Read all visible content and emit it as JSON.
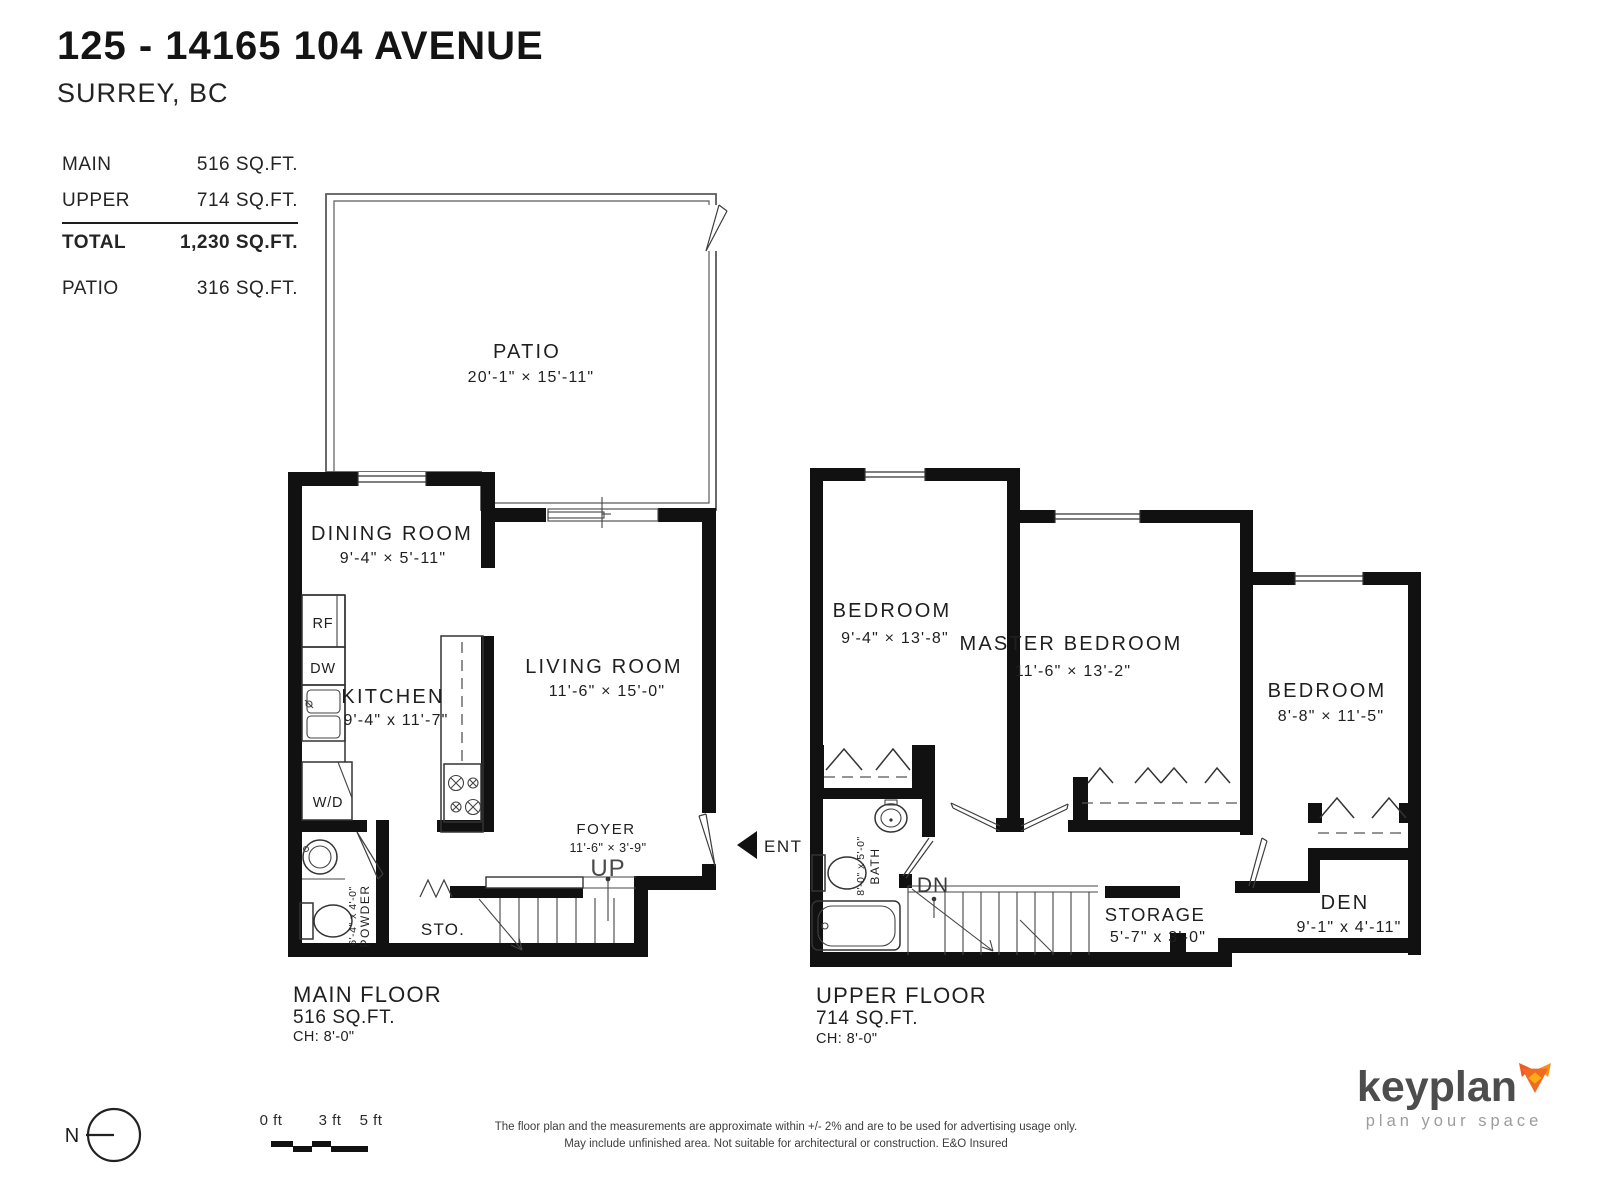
{
  "header": {
    "address": "125 - 14165 104 AVENUE",
    "city": "SURREY, BC"
  },
  "area_table": {
    "main": {
      "label": "MAIN",
      "value": "516 SQ.FT."
    },
    "upper": {
      "label": "UPPER",
      "value": "714 SQ.FT."
    },
    "total": {
      "label": "TOTAL",
      "value": "1,230 SQ.FT."
    },
    "patio": {
      "label": "PATIO",
      "value": "316 SQ.FT."
    }
  },
  "main_floor": {
    "patio": {
      "name": "PATIO",
      "dims": "20'-1\" × 15'-11\""
    },
    "dining": {
      "name": "DINING ROOM",
      "dims": "9'-4\" × 5'-11\""
    },
    "kitchen": {
      "name": "KITCHEN",
      "dims": "9'-4\" x 11'-7\""
    },
    "living": {
      "name": "LIVING ROOM",
      "dims": "11'-6\" × 15'-0\""
    },
    "foyer": {
      "name": "FOYER",
      "dims": "11'-6\" × 3'-9\""
    },
    "powder": {
      "name": "POWDER",
      "dims": "6'-4\" x 4'-0\""
    },
    "fixtures": {
      "fridge": "RF",
      "dishwasher": "DW",
      "washer_dryer": "W/D",
      "storage_closet": "STO."
    },
    "stair_label": "UP",
    "entry_label": "ENT",
    "caption": {
      "title": "MAIN FLOOR",
      "area": "516 SQ.FT.",
      "ceiling_height": "CH: 8'-0\""
    }
  },
  "upper_floor": {
    "bedroom_left": {
      "name": "BEDROOM",
      "dims": "9'-4\" × 13'-8\""
    },
    "master_bedroom": {
      "name": "MASTER BEDROOM",
      "dims": "11'-6\" × 13'-2\""
    },
    "bedroom_right": {
      "name": "BEDROOM",
      "dims": "8'-8\" × 11'-5\""
    },
    "bath": {
      "name": "BATH",
      "dims": "8'-0\" x 5'-0\""
    },
    "storage": {
      "name": "STORAGE",
      "dims": "5'-7\" x 3'-0\""
    },
    "den": {
      "name": "DEN",
      "dims": "9'-1\" x 4'-11\""
    },
    "stair_label": "DN",
    "caption": {
      "title": "UPPER FLOOR",
      "area": "714 SQ.FT.",
      "ceiling_height": "CH: 8'-0\""
    }
  },
  "footer": {
    "north_label": "N",
    "scale_labels": [
      "0 ft",
      "3 ft",
      "5 ft"
    ],
    "disclaimer_line1": "The floor plan and the measurements are approximate within +/- 2% and are to be used for advertising usage only.",
    "disclaimer_line2": "May include unfinished area. Not suitable for architectural or construction. E&O Insured",
    "brand": {
      "name": "keyplan",
      "tagline": "plan your space"
    }
  },
  "colors": {
    "wall": "#111111",
    "thin_line": "#333333",
    "patio_line": "#5a5a5a",
    "logo_gray": "#4d4d4d",
    "tagline_gray": "#9c9c9c",
    "fox_orange": "#F26A21",
    "fox_orange_dark": "#EE5A24",
    "fox_orange_light": "#FBAD18"
  }
}
